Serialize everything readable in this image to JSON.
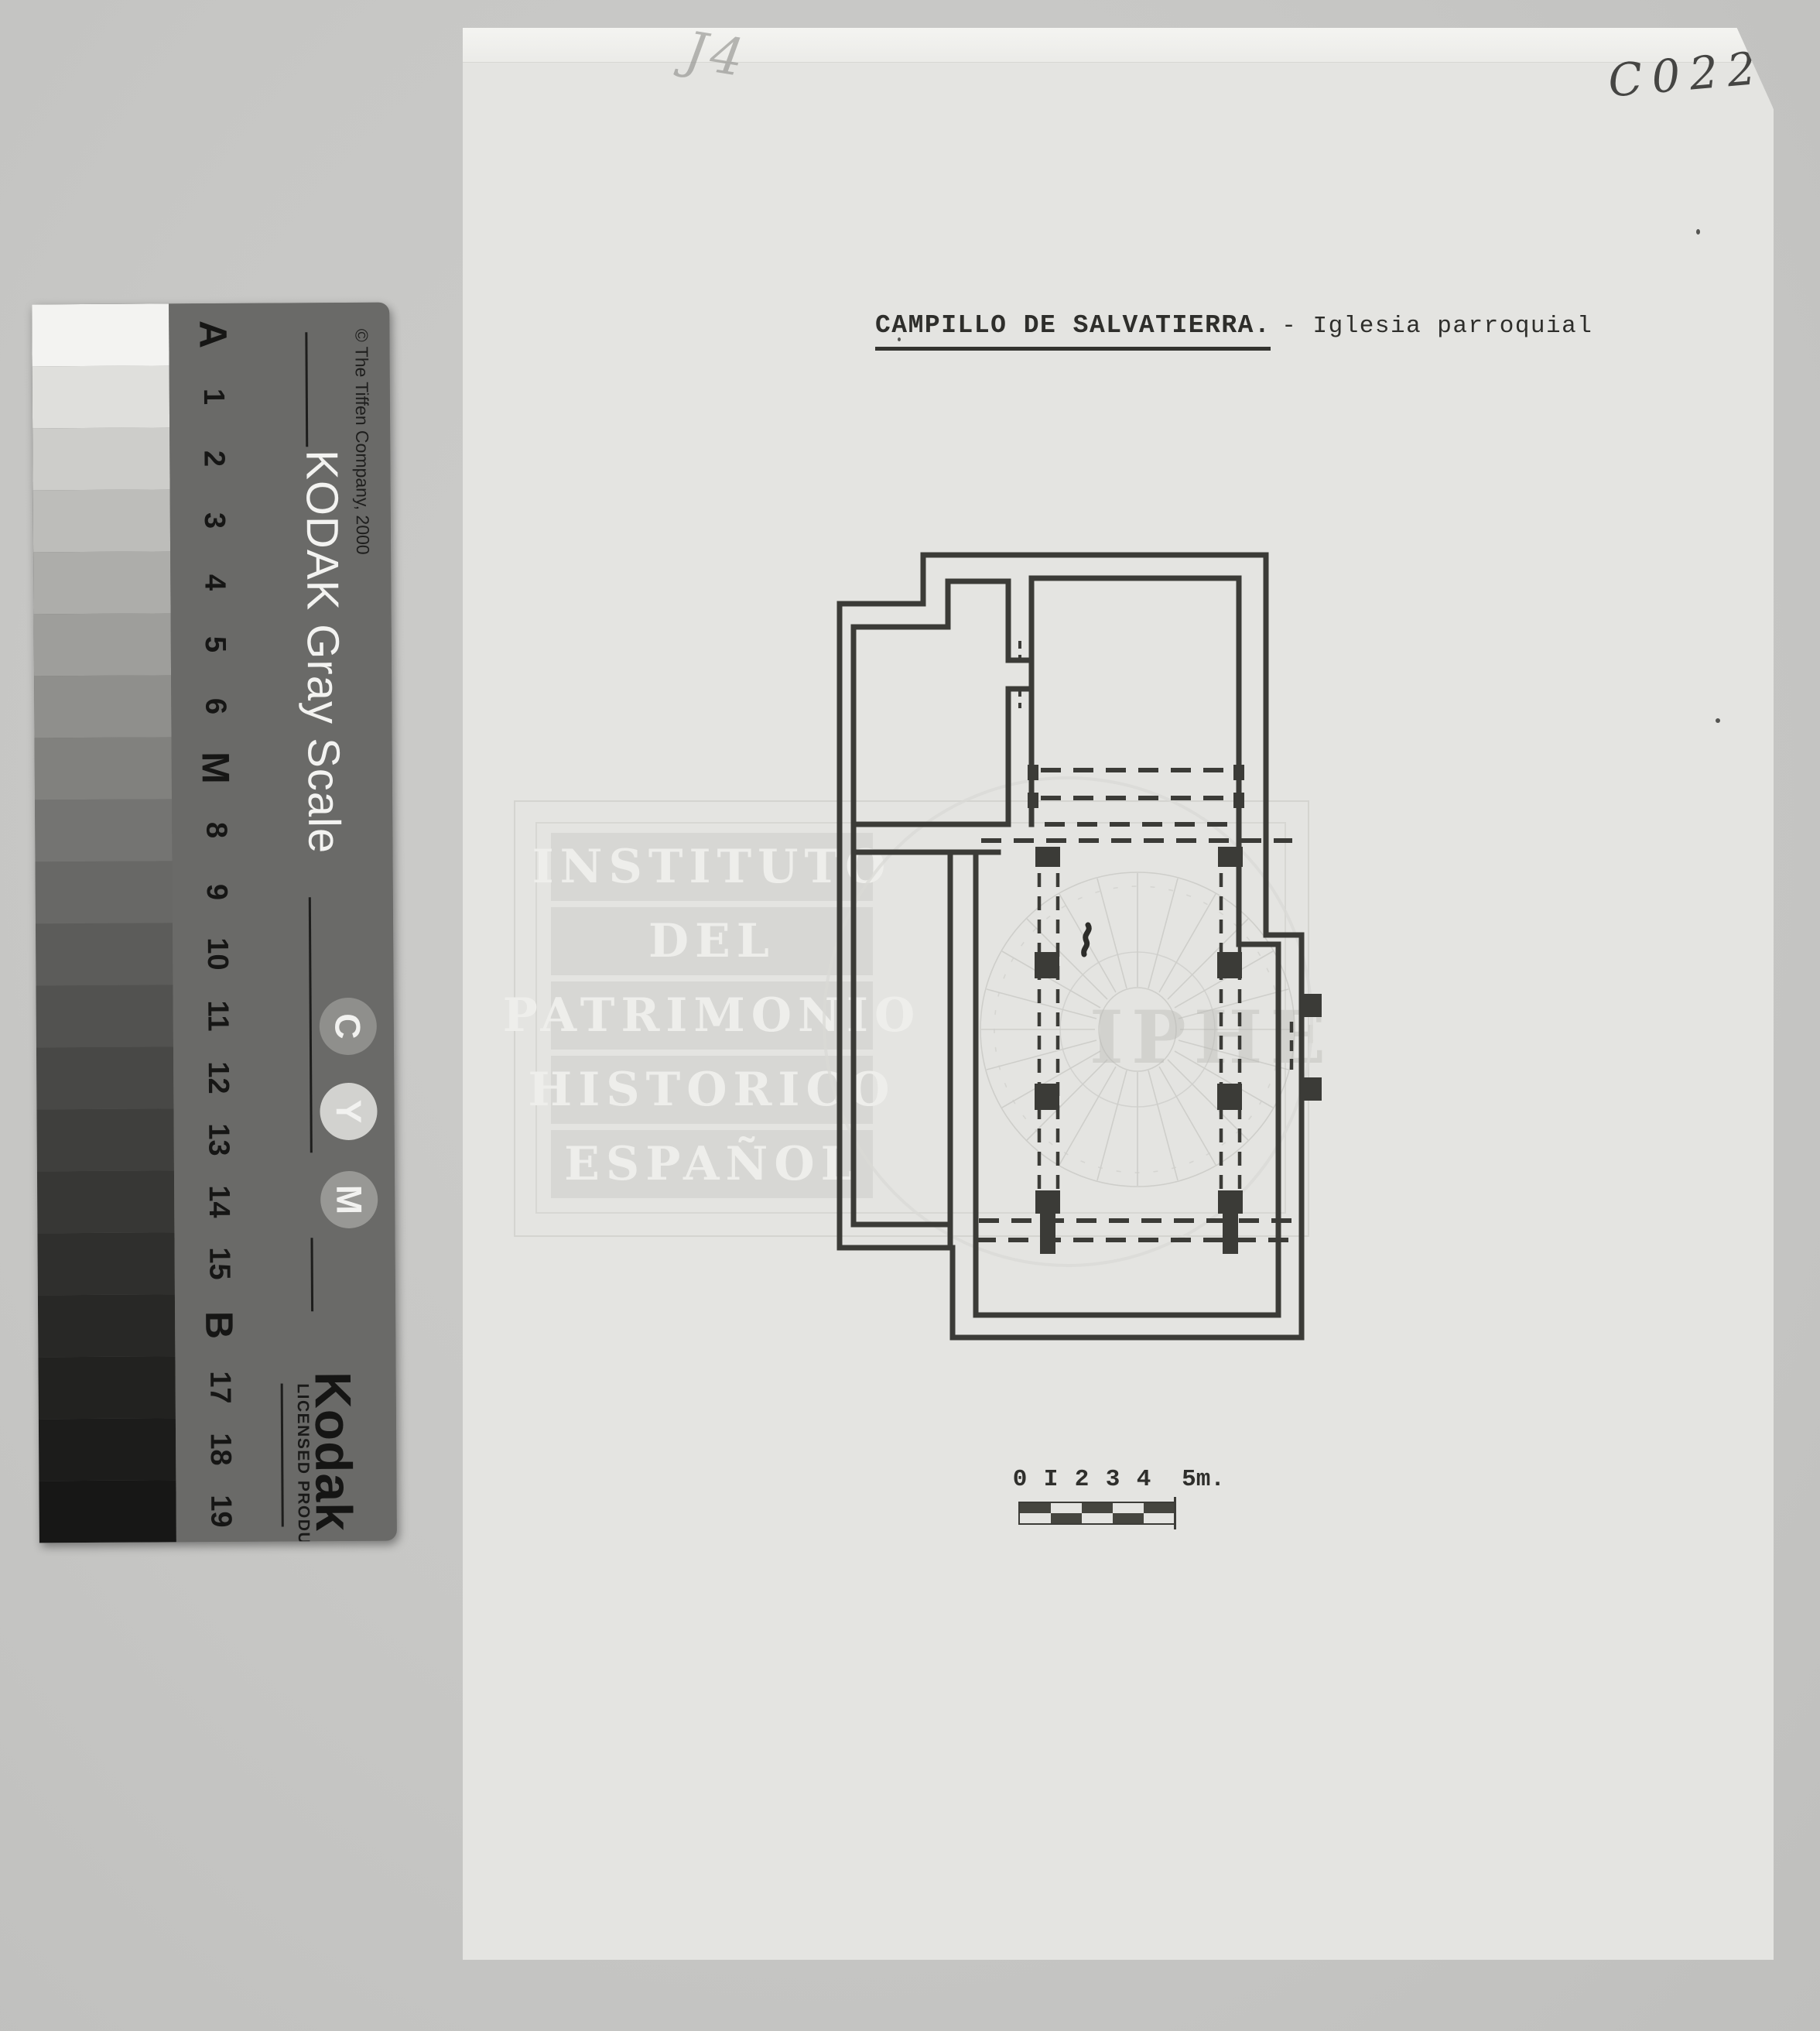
{
  "document": {
    "title_main": "CAMPILLO DE SALVATIERRA.",
    "title_sub": "- Iglesia parroquial",
    "archive_code": "C022",
    "pencil_mark": "J4"
  },
  "watermark": {
    "lines": [
      "INSTITUTO",
      "DEL",
      "PATRIMONIO",
      "HISTORICO",
      "ESPAÑOL"
    ],
    "acronym": "IPHE"
  },
  "scale_bar": {
    "labels": [
      "0",
      "I",
      "2",
      "3",
      "4"
    ],
    "end_label": "5m."
  },
  "grayscale": {
    "brand_title": "KODAK Gray Scale",
    "copyright": "© The Tiffen Company, 2000",
    "brand_footer": "Kodak",
    "license": "LICENSED PRODUCT",
    "cym": [
      "C",
      "Y",
      "M"
    ],
    "cym_colors": [
      "#8f8f8c",
      "#d2d2cf",
      "#989895"
    ],
    "labels": [
      "A",
      "1",
      "2",
      "3",
      "4",
      "5",
      "6",
      "M",
      "8",
      "9",
      "10",
      "11",
      "12",
      "13",
      "14",
      "15",
      "B",
      "17",
      "18",
      "19"
    ],
    "patch_colors": [
      "#f3f3f1",
      "#dfdfdc",
      "#cdcdca",
      "#bdbdba",
      "#adadaa",
      "#9e9e9b",
      "#8f8f8c",
      "#81817e",
      "#747472",
      "#686866",
      "#5c5c5a",
      "#525250",
      "#484846",
      "#3f3f3d",
      "#373735",
      "#2f2f2d",
      "#282826",
      "#222220",
      "#1c1c1b",
      "#171716"
    ],
    "band_color": "#6a6a68"
  },
  "colors": {
    "scanner_background": "#c8c8c6",
    "paper": "#e4e4e1",
    "ink": "#3a3a37",
    "watermark": "#d6d6d3"
  }
}
